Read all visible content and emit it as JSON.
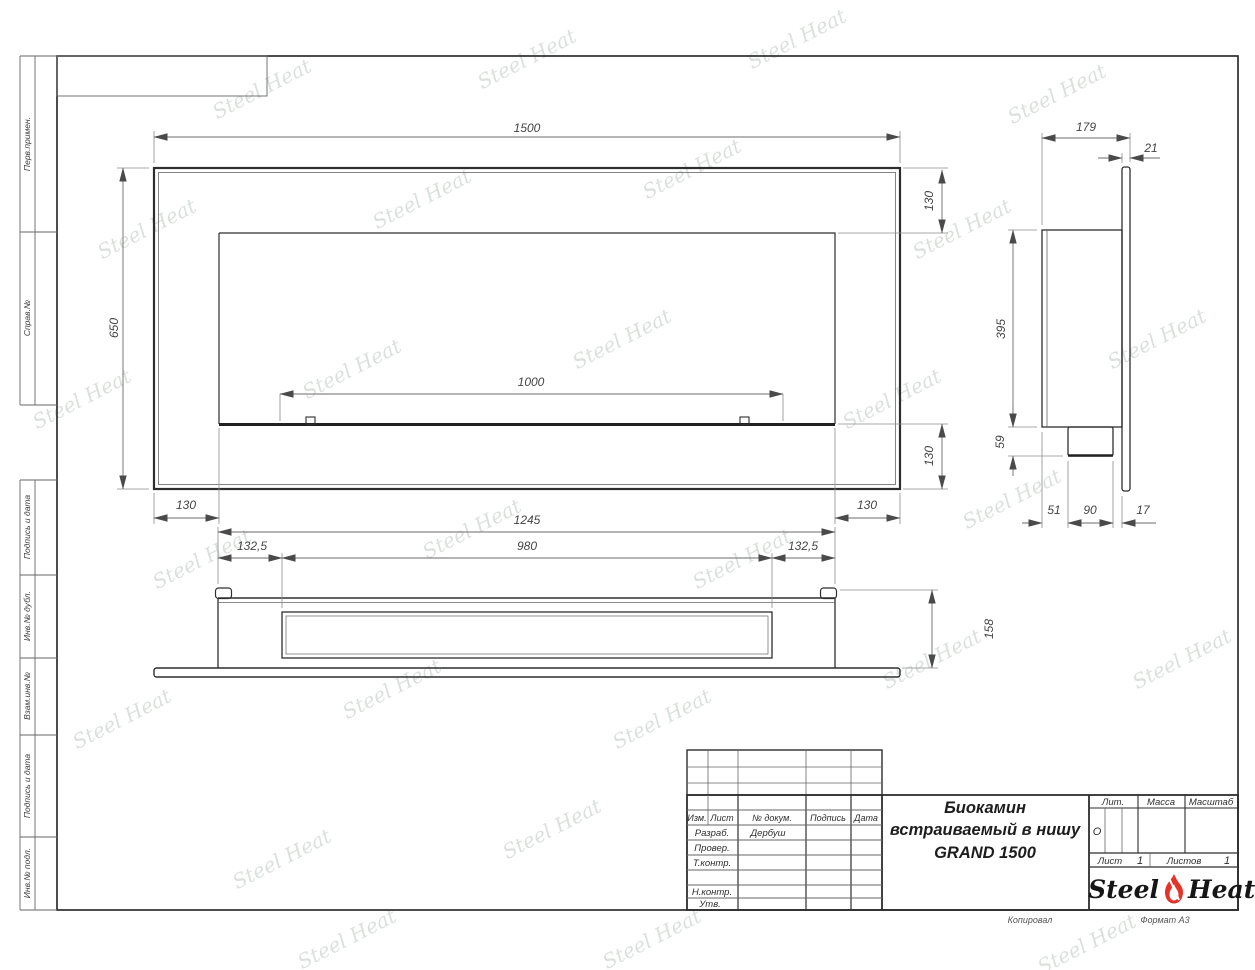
{
  "margin_labels": [
    "Перв.примен.",
    "Справ.№",
    "Подпись и дата",
    "Инв.№ дубл.",
    "Взам.инв.№",
    "Подпись и дата",
    "Инв.№ подл."
  ],
  "dims": {
    "front": {
      "width": "1500",
      "height": "650",
      "top_inset": "130",
      "bottom_inset": "130",
      "burner_width": "1000",
      "left_inset": "130",
      "right_inset": "130"
    },
    "side": {
      "depth": "179",
      "panel": "21",
      "body": "395",
      "burner_drop": "59",
      "back_offset": "51",
      "burner_depth": "90",
      "gap": "17"
    },
    "bottom": {
      "body": "1245",
      "left": "132,5",
      "recess": "980",
      "right": "132,5",
      "height": "158"
    }
  },
  "title_block": {
    "columns": [
      "Изм.",
      "Лист",
      "№ докум.",
      "Подпись",
      "Дата"
    ],
    "rows": {
      "razrab": "Разраб.",
      "name": "Дербуш",
      "prover": "Провер.",
      "tkontr": "Т.контр.",
      "nkontr": "Н.контр.",
      "utv": "Утв."
    },
    "title_lines": [
      "Биокамин",
      "встраиваемый в нишу",
      "GRAND 1500"
    ],
    "lit_label": "Лит.",
    "mass_label": "Масса",
    "scale_label": "Масштаб",
    "lit_value": "О",
    "sheet_label": "Лист",
    "sheet_value": "1",
    "sheets_label": "Листов",
    "sheets_value": "1",
    "logo": {
      "steel": "Steel",
      "heat": "Heat"
    },
    "footer": {
      "copied": "Копировал",
      "format": "Формат А3"
    }
  },
  "watermark": {
    "text": "Steel Heat"
  },
  "colors": {
    "line": "#2e2e2e",
    "dim": "#6b6b6b",
    "flame": "#e53328",
    "watermark": "#b9c3bb"
  }
}
